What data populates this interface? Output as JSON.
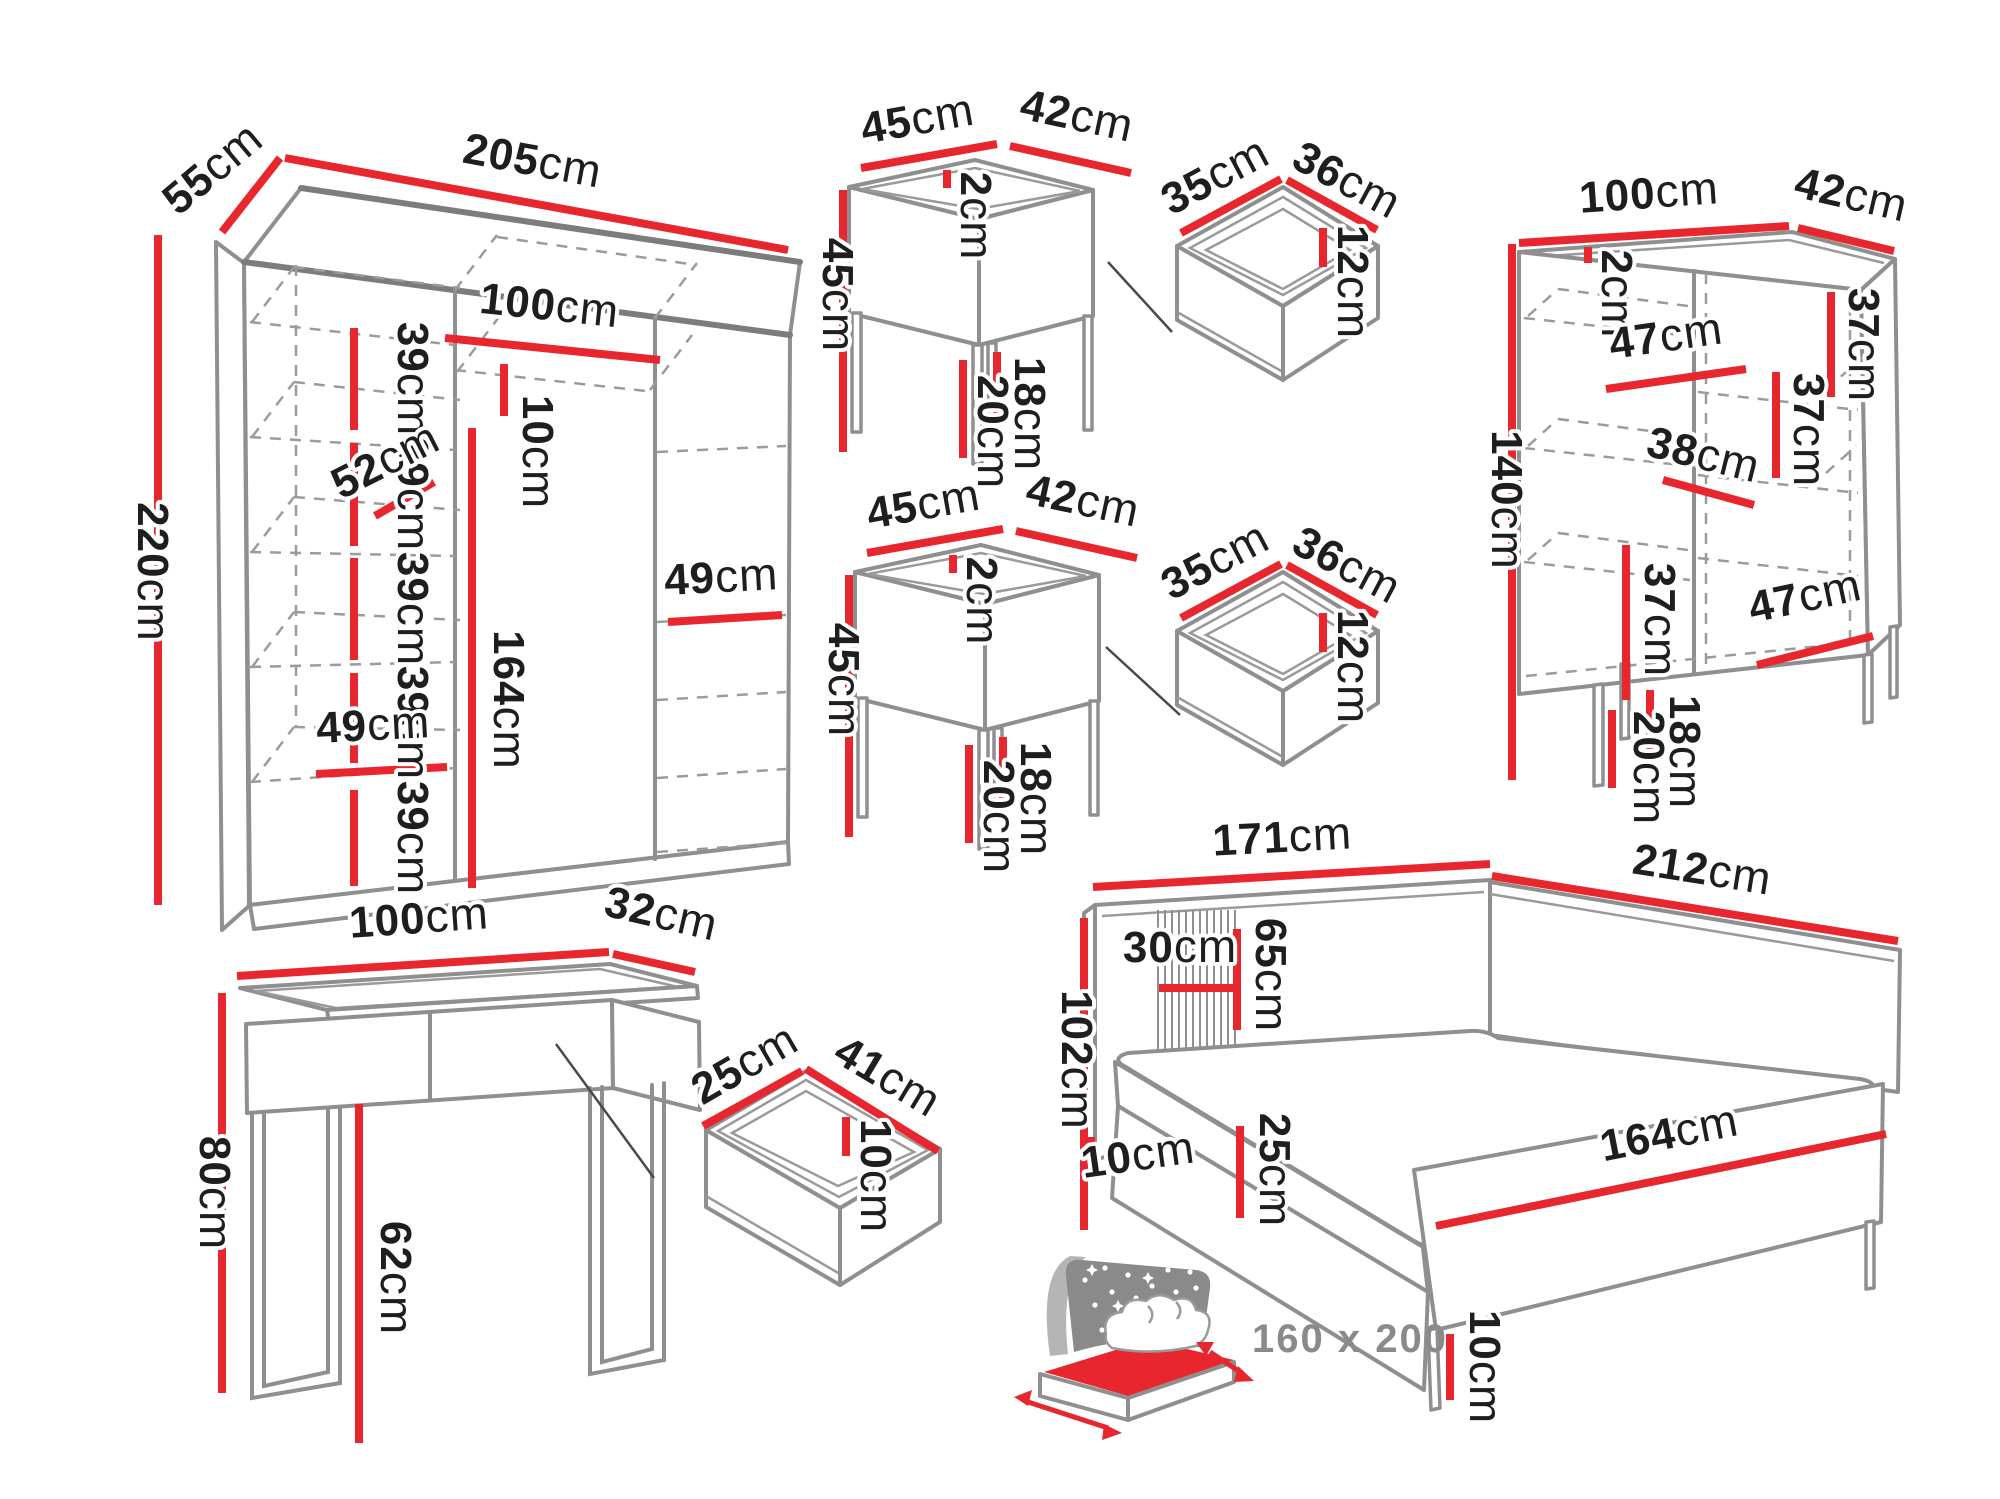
{
  "colors": {
    "dimension_red": "#e8262d",
    "outline_gray": "#8f8f8f",
    "label_dark": "#1e1e1e",
    "icon_gray": "#8a8a8a"
  },
  "wardrobe": {
    "width": {
      "v": "205",
      "u": "cm"
    },
    "depth": {
      "v": "55",
      "u": "cm"
    },
    "height": {
      "v": "220",
      "u": "cm"
    },
    "shelf_gaps": [
      {
        "v": "39",
        "u": "cm"
      },
      {
        "v": "39",
        "u": "cm"
      },
      {
        "v": "39",
        "u": "cm"
      },
      {
        "v": "39",
        "u": "cm"
      },
      {
        "v": "39",
        "u": "cm"
      }
    ],
    "inner_width": {
      "v": "100",
      "u": "cm"
    },
    "rod_offset": {
      "v": "10",
      "u": "cm"
    },
    "shelf_depth": {
      "v": "52",
      "u": "cm"
    },
    "hanging_height": {
      "v": "164",
      "u": "cm"
    },
    "shelf_width_lower": {
      "v": "49",
      "u": "cm"
    },
    "shelf_width_right": {
      "v": "49",
      "u": "cm"
    }
  },
  "nightstand_top": {
    "width": {
      "v": "45",
      "u": "cm"
    },
    "depth": {
      "v": "42",
      "u": "cm"
    },
    "height": {
      "v": "45",
      "u": "cm"
    },
    "top_thickness": {
      "v": "2",
      "u": "cm"
    },
    "leg_height_front": {
      "v": "20",
      "u": "cm"
    },
    "leg_height_back": {
      "v": "18",
      "u": "cm"
    }
  },
  "drawer_top": {
    "width": {
      "v": "35",
      "u": "cm"
    },
    "depth": {
      "v": "36",
      "u": "cm"
    },
    "height": {
      "v": "12",
      "u": "cm"
    }
  },
  "nightstand_bottom": {
    "width": {
      "v": "45",
      "u": "cm"
    },
    "depth": {
      "v": "42",
      "u": "cm"
    },
    "height": {
      "v": "45",
      "u": "cm"
    },
    "top_thickness": {
      "v": "2",
      "u": "cm"
    },
    "leg_height_front": {
      "v": "20",
      "u": "cm"
    },
    "leg_height_back": {
      "v": "18",
      "u": "cm"
    }
  },
  "drawer_bottom": {
    "width": {
      "v": "35",
      "u": "cm"
    },
    "depth": {
      "v": "36",
      "u": "cm"
    },
    "height": {
      "v": "12",
      "u": "cm"
    }
  },
  "cabinet": {
    "width": {
      "v": "100",
      "u": "cm"
    },
    "depth": {
      "v": "42",
      "u": "cm"
    },
    "top_thickness": {
      "v": "2",
      "u": "cm"
    },
    "height": {
      "v": "140",
      "u": "cm"
    },
    "shelf_top_right": {
      "v": "37",
      "u": "cm"
    },
    "shelf_width_left": {
      "v": "47",
      "u": "cm"
    },
    "shelf_mid_right": {
      "v": "37",
      "u": "cm"
    },
    "shelf_depth_mid": {
      "v": "38",
      "u": "cm"
    },
    "shelf_bottom_left": {
      "v": "37",
      "u": "cm"
    },
    "shelf_width_bottom_right": {
      "v": "47",
      "u": "cm"
    },
    "leg_height_back": {
      "v": "18",
      "u": "cm"
    },
    "leg_height_front": {
      "v": "20",
      "u": "cm"
    }
  },
  "console": {
    "width": {
      "v": "100",
      "u": "cm"
    },
    "depth": {
      "v": "32",
      "u": "cm"
    },
    "height": {
      "v": "80",
      "u": "cm"
    },
    "clearance": {
      "v": "62",
      "u": "cm"
    }
  },
  "console_drawer": {
    "depth": {
      "v": "25",
      "u": "cm"
    },
    "width": {
      "v": "41",
      "u": "cm"
    },
    "height": {
      "v": "10",
      "u": "cm"
    }
  },
  "bed": {
    "headboard_width": {
      "v": "171",
      "u": "cm"
    },
    "length": {
      "v": "212",
      "u": "cm"
    },
    "headboard_height": {
      "v": "102",
      "u": "cm"
    },
    "panel_width": {
      "v": "30",
      "u": "cm"
    },
    "panel_height": {
      "v": "65",
      "u": "cm"
    },
    "headboard_clearance": {
      "v": "10",
      "u": "cm"
    },
    "frame_height": {
      "v": "25",
      "u": "cm"
    },
    "foot_width": {
      "v": "164",
      "u": "cm"
    },
    "leg_height": {
      "v": "10",
      "u": "cm"
    }
  },
  "mattress_badge": {
    "size": "160 x 200"
  }
}
